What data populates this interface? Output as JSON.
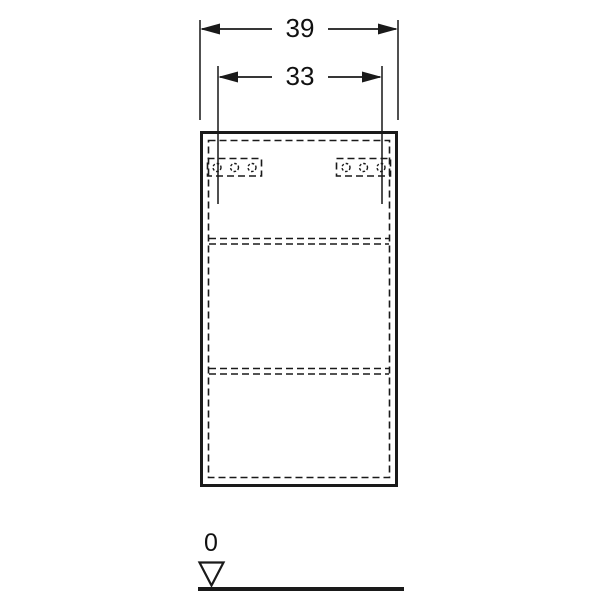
{
  "colors": {
    "line": "#1a1a1a",
    "extension_line": "#3c3c3c",
    "background": "#ffffff"
  },
  "drawing": {
    "dimensions": [
      {
        "id": "overall-width",
        "label": "39"
      },
      {
        "id": "hole-spacing",
        "label": "33"
      }
    ],
    "datum": {
      "label": "0"
    }
  }
}
